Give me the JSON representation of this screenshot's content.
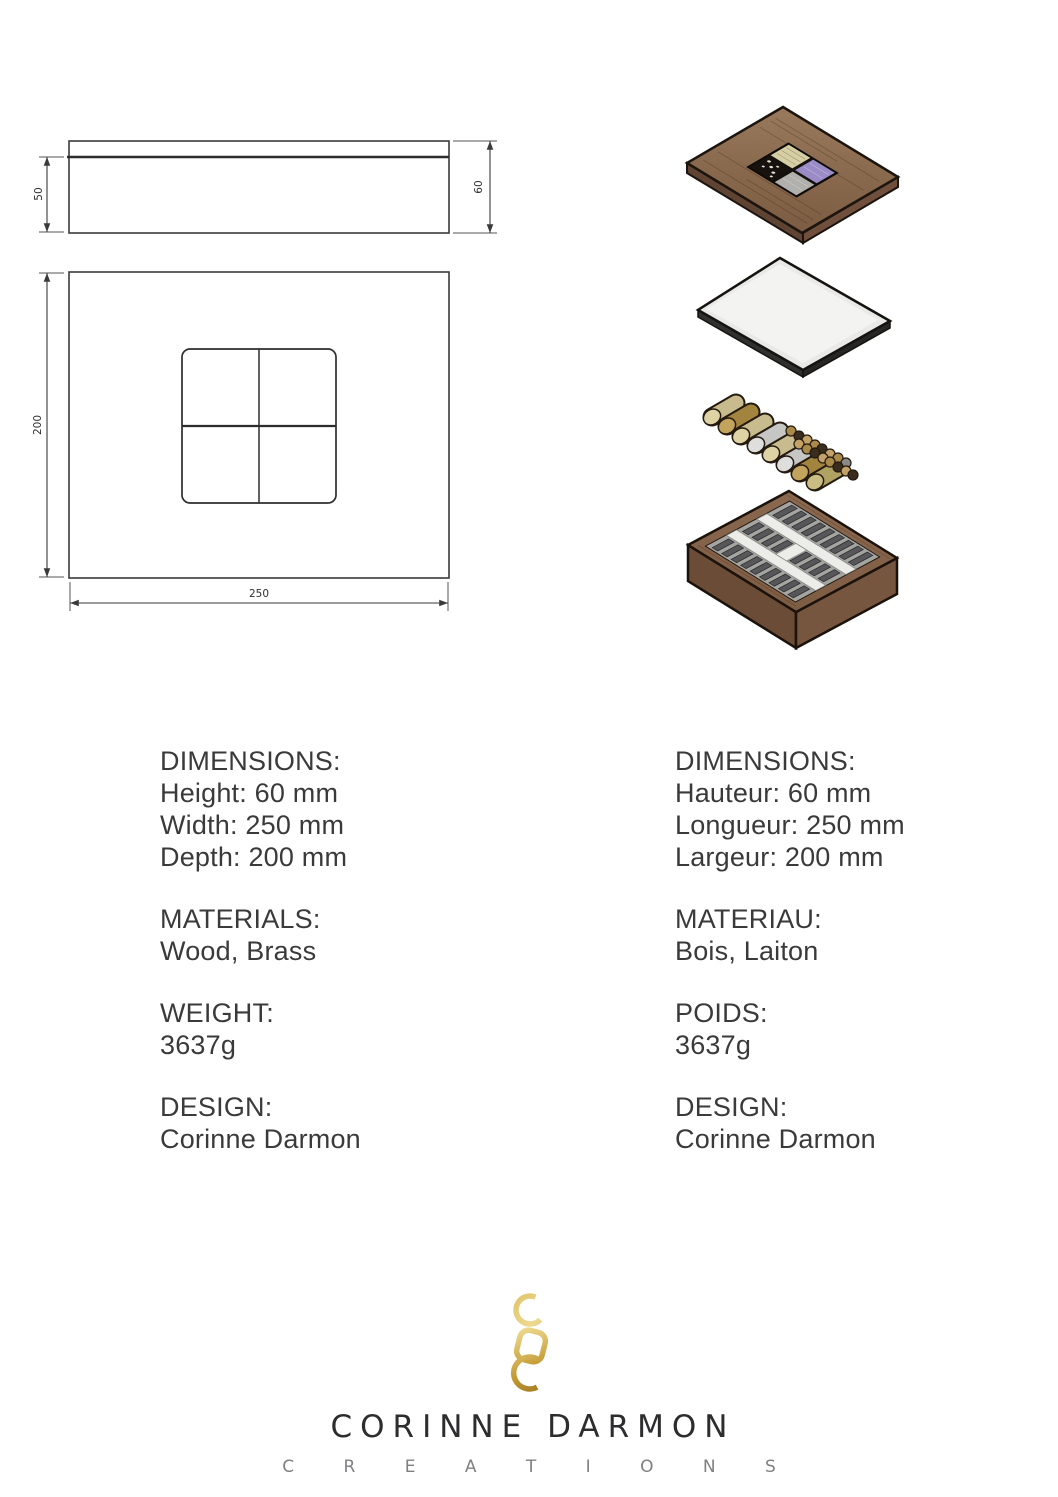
{
  "drawing": {
    "side_view": {
      "inner_height": "50",
      "total_height": "60"
    },
    "top_view": {
      "depth": "200",
      "width": "250"
    }
  },
  "specs": {
    "en": {
      "dimensions_label": "DIMENSIONS:",
      "height": "Height: 60 mm",
      "width": "Width: 250 mm",
      "depth": "Depth: 200 mm",
      "materials_label": "MATERIALS:",
      "materials": "Wood, Brass",
      "weight_label": "WEIGHT:",
      "weight": "3637g",
      "design_label": "DESIGN:",
      "designer": "Corinne Darmon"
    },
    "fr": {
      "dimensions_label": "DIMENSIONS:",
      "height": "Hauteur: 60 mm",
      "width": "Longueur: 250 mm",
      "depth": "Largeur: 200 mm",
      "materials_label": "MATERIAU:",
      "materials": "Bois, Laiton",
      "weight_label": "POIDS:",
      "weight": "3637g",
      "design_label": "DESIGN:",
      "designer": "Corinne Darmon"
    }
  },
  "footer": {
    "brand": "CORINNE DARMON",
    "tagline": "C R E A T I O N S",
    "monogram_letters": "CDC"
  },
  "colors": {
    "wood": "#8a6a4e",
    "wood_side_dark": "#5f4433",
    "wood_side": "#70503c",
    "box_rim": "#7d5c43",
    "box_side_left": "#6a4c37",
    "box_side_right": "#775640",
    "inlay_cream": "#d6cfa6",
    "inlay_purple": "#9b8cc8",
    "inlay_silver": "#b2b0ac",
    "inlay_black": "#17120e",
    "plate": "#e9e9e7",
    "brass": "#a3843f",
    "khaki": "#c8bc8e",
    "silver": "#c6c6c4",
    "gold_light": "#edd98f",
    "gold": "#d9b855",
    "gold_mid": "#c49a33",
    "gold_dark": "#8f681c",
    "line": "#3a3a3a"
  }
}
